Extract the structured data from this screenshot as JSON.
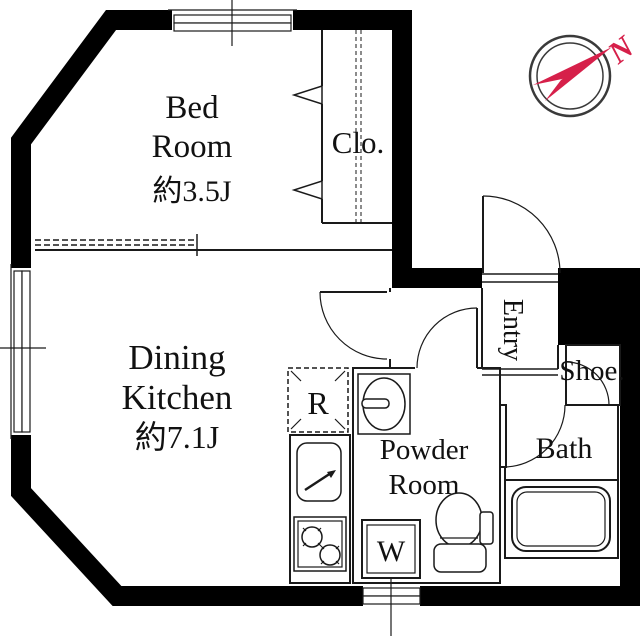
{
  "plan": {
    "rooms": {
      "bedroom": {
        "name": [
          "Bed",
          "Room"
        ],
        "area": "約3.5J"
      },
      "dining_kitchen": {
        "name": [
          "Dining",
          "Kitchen"
        ],
        "area": "約7.1J"
      },
      "closet": {
        "label": "Clo."
      },
      "powder_room": {
        "name": [
          "Powder",
          "Room"
        ]
      },
      "bath": {
        "label": "Bath"
      },
      "entry": {
        "label": "Entry"
      },
      "shoe": {
        "label": "Shoe."
      },
      "refrigerator": {
        "label": "R"
      },
      "washer": {
        "label": "W"
      }
    },
    "compass": {
      "label": "N",
      "color": "#d6204a",
      "ring_color": "#3a3a3a"
    },
    "colors": {
      "wall": "#000000",
      "line": "#1a1a1a",
      "background": "#ffffff"
    }
  }
}
